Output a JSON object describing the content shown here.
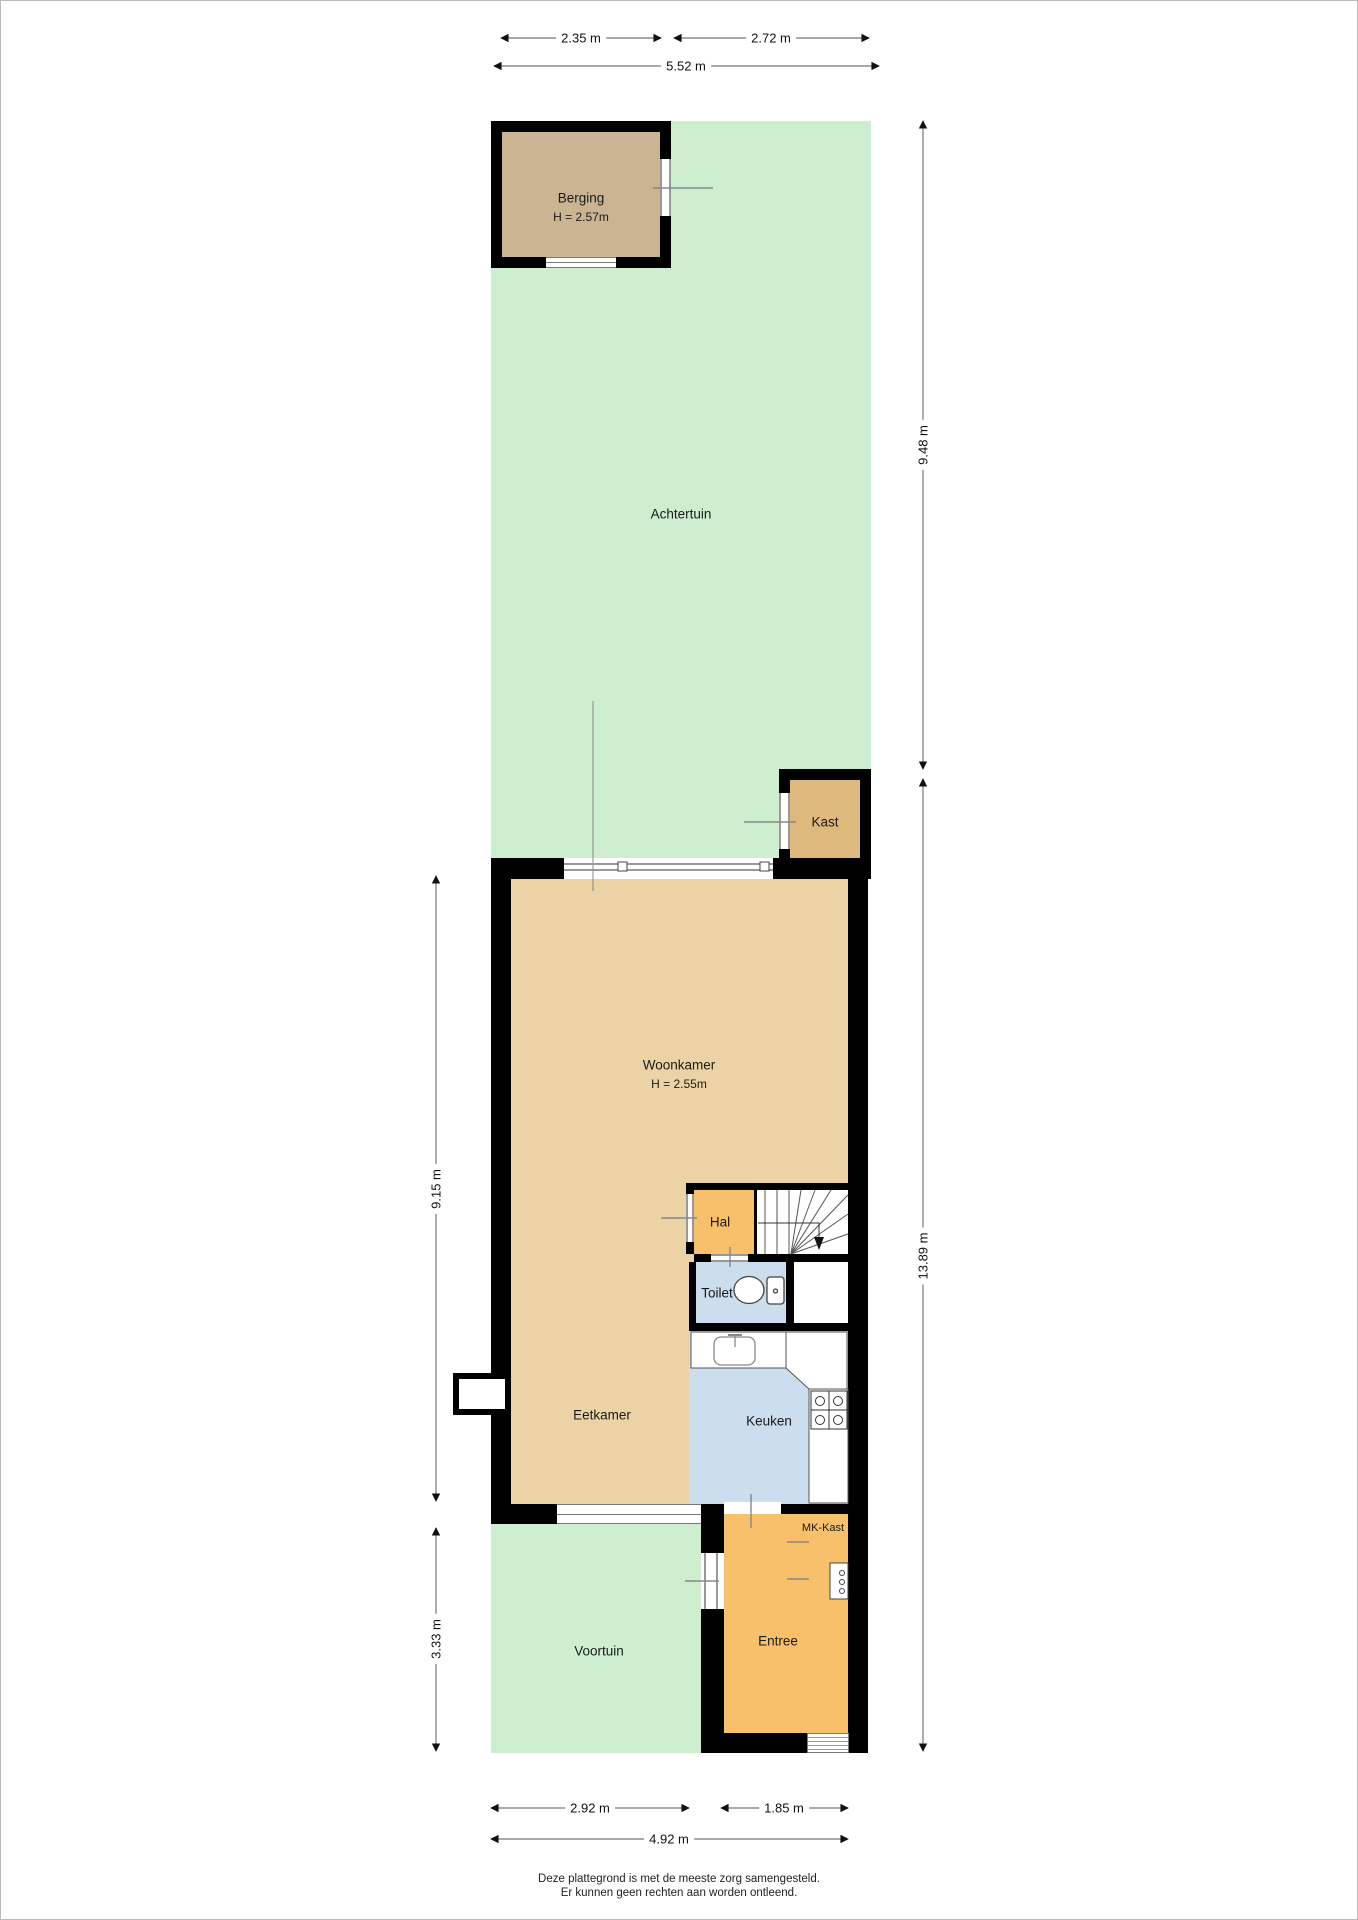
{
  "plan": {
    "footer": {
      "line1": "Deze plattegrond is met de meeste zorg samengesteld.",
      "line2": "Er kunnen geen rechten aan worden ontleend."
    },
    "rooms": {
      "berging": {
        "label": "Berging",
        "ceiling_height": "H = 2.57m"
      },
      "achtertuin": {
        "label": "Achtertuin"
      },
      "kast": {
        "label": "Kast"
      },
      "woonkamer": {
        "label": "Woonkamer",
        "ceiling_height": "H = 2.55m"
      },
      "hal": {
        "label": "Hal"
      },
      "toilet": {
        "label": "Toilet"
      },
      "eetkamer": {
        "label": "Eetkamer"
      },
      "keuken": {
        "label": "Keuken"
      },
      "mk_kast": {
        "label": "MK-Kast"
      },
      "entree": {
        "label": "Entree"
      },
      "voortuin": {
        "label": "Voortuin"
      }
    },
    "dimensions": {
      "berging_width": "2.35 m",
      "achtertuin_top_width": "2.72 m",
      "plot_top_width": "5.52 m",
      "achtertuin_depth": "9.48 m",
      "house_plus_voortuin_depth": "13.89 m",
      "house_depth": "9.15 m",
      "voortuin_depth": "3.33 m",
      "voortuin_width": "2.92 m",
      "entree_width": "1.85 m",
      "house_width": "4.92 m"
    },
    "colors": {
      "wall": "#000000",
      "garden": "#cdeecf",
      "living_floor": "#ebd3a6",
      "storage_floor": "#cbb492",
      "closet_floor": "#deb97d",
      "hall_floor": "#f8c06a",
      "wet_room_floor": "#ccddee"
    }
  }
}
